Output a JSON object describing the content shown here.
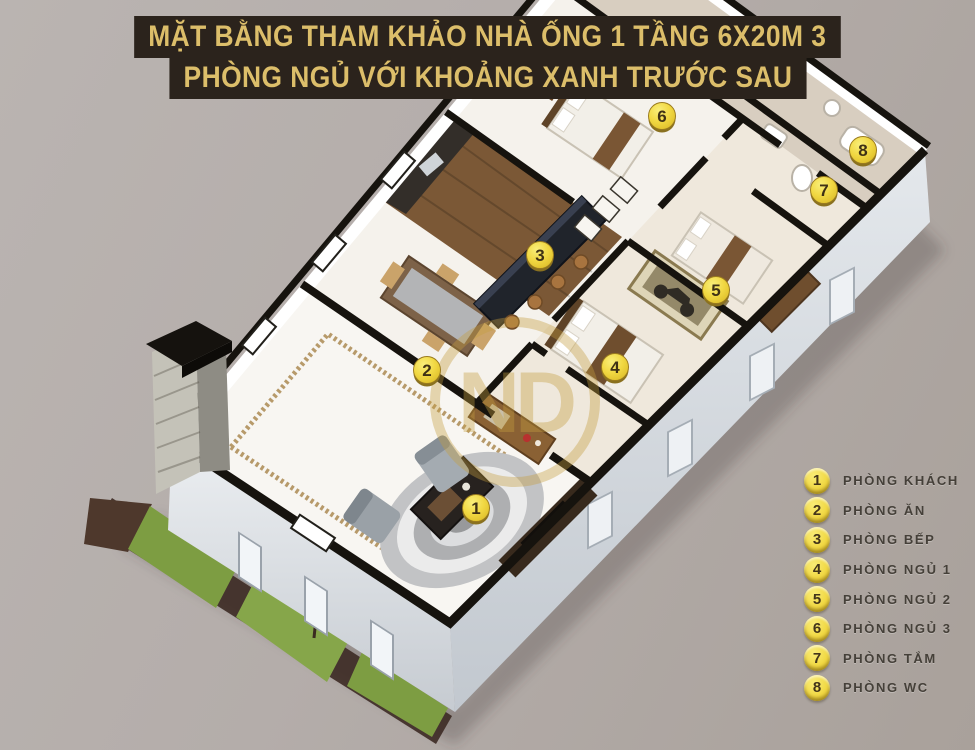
{
  "title": {
    "line1": "MẶT BẰNG THAM KHẢO NHÀ ỐNG 1 TẦNG 6X20M 3",
    "line2": "PHÒNG NGỦ VỚI KHOẢNG XANH TRƯỚC SAU"
  },
  "legend": {
    "items": [
      {
        "number": "1",
        "label": "PHÒNG KHÁCH"
      },
      {
        "number": "2",
        "label": "PHÒNG ĂN"
      },
      {
        "number": "3",
        "label": "PHÒNG BẾP"
      },
      {
        "number": "4",
        "label": "PHÒNG NGỦ 1"
      },
      {
        "number": "5",
        "label": "PHÒNG NGỦ 2"
      },
      {
        "number": "6",
        "label": "PHÒNG NGỦ 3"
      },
      {
        "number": "7",
        "label": "PHÒNG TẮM"
      },
      {
        "number": "8",
        "label": "PHÒNG WC"
      }
    ]
  },
  "markers": [
    {
      "number": "1",
      "label": "PHÒNG KHÁCH",
      "x": 476,
      "y": 508
    },
    {
      "number": "2",
      "label": "PHÒNG ĂN",
      "x": 427,
      "y": 370
    },
    {
      "number": "3",
      "label": "PHÒNG BẾP",
      "x": 540,
      "y": 255
    },
    {
      "number": "4",
      "label": "PHÒNG NGỦ 1",
      "x": 615,
      "y": 367
    },
    {
      "number": "5",
      "label": "PHÒNG NGỦ 2",
      "x": 716,
      "y": 290
    },
    {
      "number": "6",
      "label": "PHÒNG NGỦ 3",
      "x": 662,
      "y": 116
    },
    {
      "number": "7",
      "label": "PHÒNG TẮM",
      "x": 824,
      "y": 190
    },
    {
      "number": "8",
      "label": "PHÒNG WC",
      "x": 863,
      "y": 150
    }
  ],
  "watermark": "ND",
  "colors": {
    "banner_bg": "#2b231c",
    "banner_text": "#dcbe6a",
    "marker_yellow": "#f1d843",
    "wall_black": "#16130e",
    "grass_green": "#7d9d42",
    "soil_brown": "#3c2a23",
    "wood_brown": "#7b5836"
  }
}
